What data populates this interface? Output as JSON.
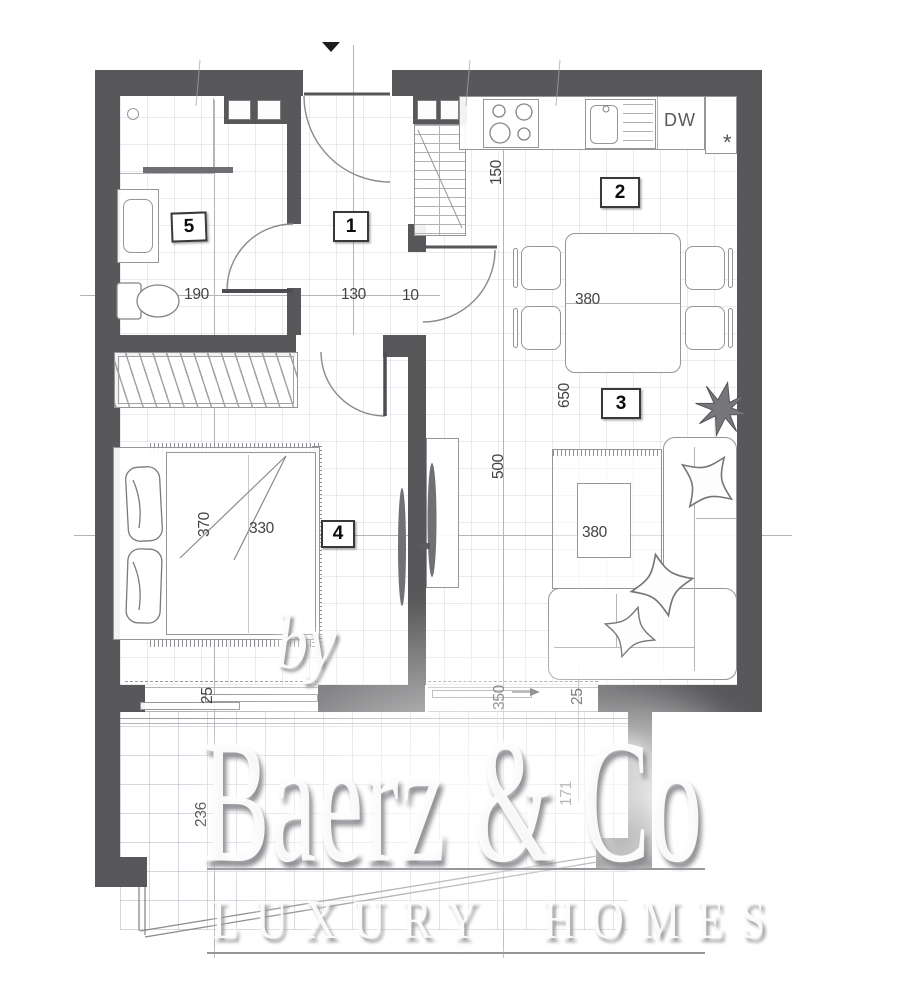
{
  "plan": {
    "room_numbers": [
      "1",
      "2",
      "3",
      "4",
      "5"
    ],
    "dims": {
      "bath_h": "270",
      "bath_w": "190",
      "hall_w": "130",
      "gap": "10",
      "kitchen_d": "150",
      "dining_w": "380",
      "living_l": "650",
      "living_w": "500",
      "bed_l": "370",
      "bed_w": "330",
      "rug_w": "380",
      "win_left": "25",
      "terrace_door": "350",
      "terrace_door_side": "25",
      "terrace_d": "236",
      "terrace_w": "493",
      "terrace_s": "171"
    },
    "labels": {
      "dishwasher": "DW",
      "appliance_marker": "*"
    }
  },
  "watermark": {
    "pre": "by",
    "brand": "Baerz & Co",
    "tagline": "LUXURY HOMES"
  },
  "colors": {
    "wall": "#58585b",
    "line": "#95959a",
    "dim_text": "#434347"
  }
}
